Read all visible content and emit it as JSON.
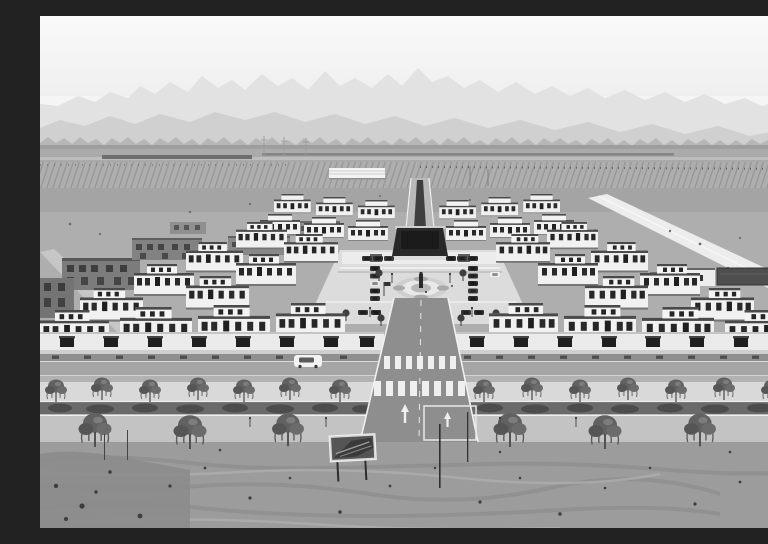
{
  "figure": {
    "kind": "black-and-white aerial photograph",
    "description": "Aerial black-and-white photograph of a newly built, symmetrical rural residential community: stepped rows of white two-storey courtyard houses surround a central plaza with a dark stage, parked cars and a circular medallion; a main road with zebra crosswalks and lane arrows leads toward tree-lined streets and a bare dirt field in the foreground; unfinished brick houses and striped farmland lie to the left, a bright diagonal road to the right, and layered mountain ridges fade into a pale sky."
  },
  "scene": {
    "regions": [
      {
        "name": "sky"
      },
      {
        "name": "mountain-ridges"
      },
      {
        "name": "farmland-plain"
      },
      {
        "name": "housing-community"
      },
      {
        "name": "central-plaza"
      },
      {
        "name": "plaza-stage"
      },
      {
        "name": "plaza-medallion"
      },
      {
        "name": "main-road"
      },
      {
        "name": "crosswalks"
      },
      {
        "name": "tree-lined-streets"
      },
      {
        "name": "dirt-foreground"
      },
      {
        "name": "unfinished-buildings"
      },
      {
        "name": "construction-sign-board"
      },
      {
        "name": "white-suv"
      }
    ],
    "counts": {
      "house_blocks": 34,
      "parked_cars": 21,
      "street_trees": 21,
      "plaza_trees": 6,
      "crosswalks": 2
    },
    "palette": {
      "sky": "#f5f5f5",
      "ridge_far": "#e2e2e2",
      "ridge_mid": "#d0d0d0",
      "ridge_near": "#b7b7b7",
      "plain": "#a9a9a9",
      "cleared_ground": "#aeaeae",
      "house_wall": "#f1f1f1",
      "house_roof": "#4a4a4a",
      "window": "#262626",
      "plaza": "#dcdcdc",
      "stage": "#282828",
      "road": "#8e8e8e",
      "road_marking": "#efefef",
      "hedge": "#4c4c4c",
      "dirt": "#9c9c9c"
    }
  }
}
